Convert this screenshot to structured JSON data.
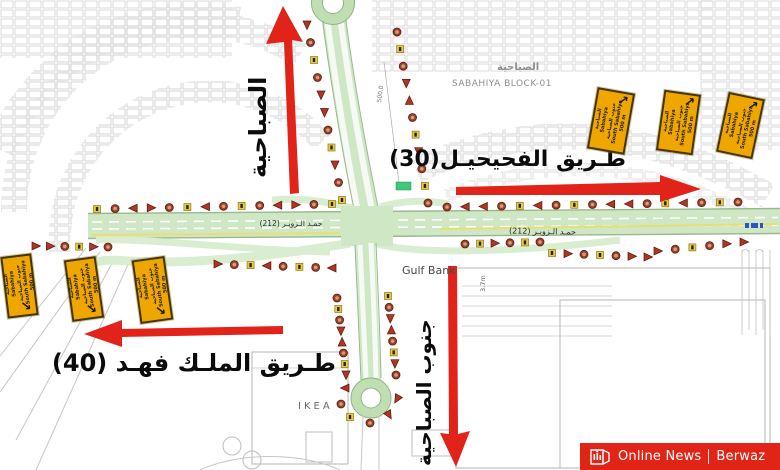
{
  "map": {
    "labels": {
      "sabahiya_vertical": "الصباحية",
      "fahaheel_road": "طـريق الفحيحيـل(30)",
      "king_fahd_road": "طـريق الملـك فهـد (40)",
      "south_sabahiya_vertical": "جنوب الصباحية",
      "sabahiya_block_ar": "الصباحية",
      "sabahiya_block_en": "SABAHIYA BLOCK-01",
      "road_212_left": "حمـد الـزويـر (212)",
      "road_212_right": "حمـد الـزويـر (212)",
      "gulf_bank": "Gulf Bank",
      "ikea": "IKEA",
      "dim_500": "500.0",
      "dim_37": "3.7m"
    }
  },
  "direction_signs": {
    "line1": "الصباحية",
    "line2": "Sabahiya",
    "line3": "جنوب الصباحية",
    "line4": "South Sabahiya",
    "distance": "500 m"
  },
  "watermark": {
    "news": "Online News",
    "brand": "Berwaz"
  }
}
